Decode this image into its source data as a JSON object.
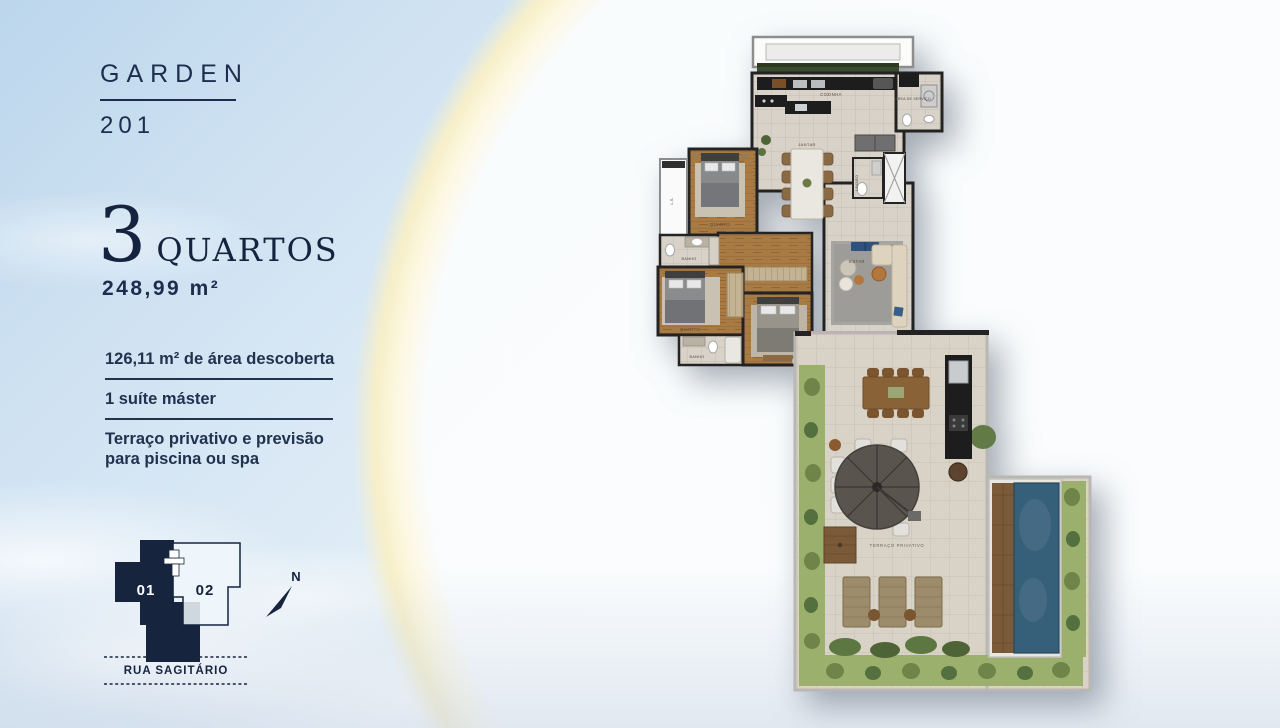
{
  "panel": {
    "title": "GARDEN",
    "unit_number": "201",
    "bedrooms_count": "3",
    "bedrooms_label": "QUARTOS",
    "total_area": "248,99 m²",
    "features": [
      {
        "text": "126,11 m² de área descoberta"
      },
      {
        "text": "1 suíte máster"
      },
      {
        "text": "Terraço privativo e previsão para piscina ou spa"
      }
    ]
  },
  "key_plan": {
    "unit_highlighted": "01",
    "unit_other": "02",
    "north_label": "N",
    "street_name": "RUA SAGITÁRIO"
  },
  "floor_plan": {
    "rooms": {
      "cozinha": "COZINHA",
      "area_servico": "ÁREA DE SERVIÇO",
      "jantar": "JANTAR",
      "lavabo": "LAVABO",
      "quarto_1": "QUARTO",
      "banho_1": "BANHO",
      "quarto_2": "QUARTO",
      "banho_2": "BANHO",
      "suite": "SUÍTE",
      "estar": "ESTAR",
      "terraco": "TERRAÇO PRIVATIVO",
      "ls": "L.S."
    },
    "colors": {
      "navy": "#1c2d4d",
      "wall": "#232323",
      "tile": "#d8d2c8",
      "wood": "#a87a44",
      "pool_water": "#36607a",
      "garden": "#9ab06c",
      "planter": "#3a4a2c",
      "arc_cream": "#f7efc9"
    }
  }
}
